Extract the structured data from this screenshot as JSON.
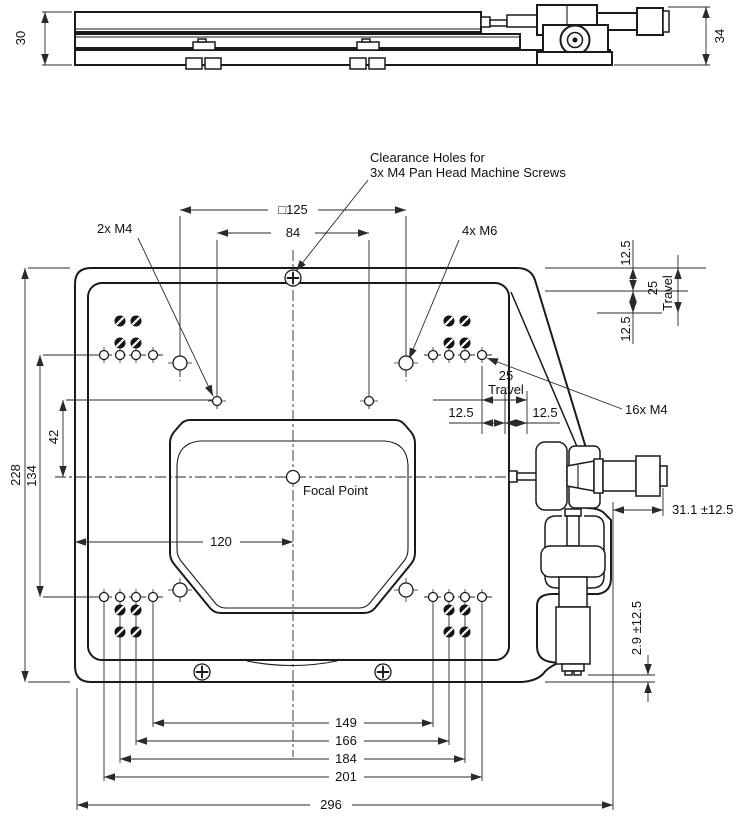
{
  "page": {
    "background": "#ffffff",
    "ink": "#1a1a1a"
  },
  "side_view": {
    "dims": {
      "stage_height": "30",
      "overall_height": "34"
    }
  },
  "plan_view": {
    "callouts": {
      "clearance_line1": "Clearance Holes for",
      "clearance_line2": "3x M4 Pan Head Machine Screws",
      "two_m4": "2x M4",
      "four_m6": "4x M6",
      "sixteen_m4": "16x M4",
      "focal_point": "Focal Point"
    },
    "dims": {
      "square_125": "□125",
      "d84": "84",
      "d120": "120",
      "d42": "42",
      "d134": "134",
      "d228": "228",
      "d149": "149",
      "d166": "166",
      "d184": "184",
      "d201": "201",
      "d296": "296",
      "cluster_travel_value": "25",
      "cluster_travel_word": "Travel",
      "cluster_half_left": "12.5",
      "cluster_half_right": "12.5",
      "edge_travel_value": "25",
      "edge_travel_word": "Travel",
      "edge_half_top": "12.5",
      "edge_half_bottom": "12.5",
      "x_extension": "31.1 ±12.5",
      "y_extension": "2.9 ±12.5"
    }
  }
}
